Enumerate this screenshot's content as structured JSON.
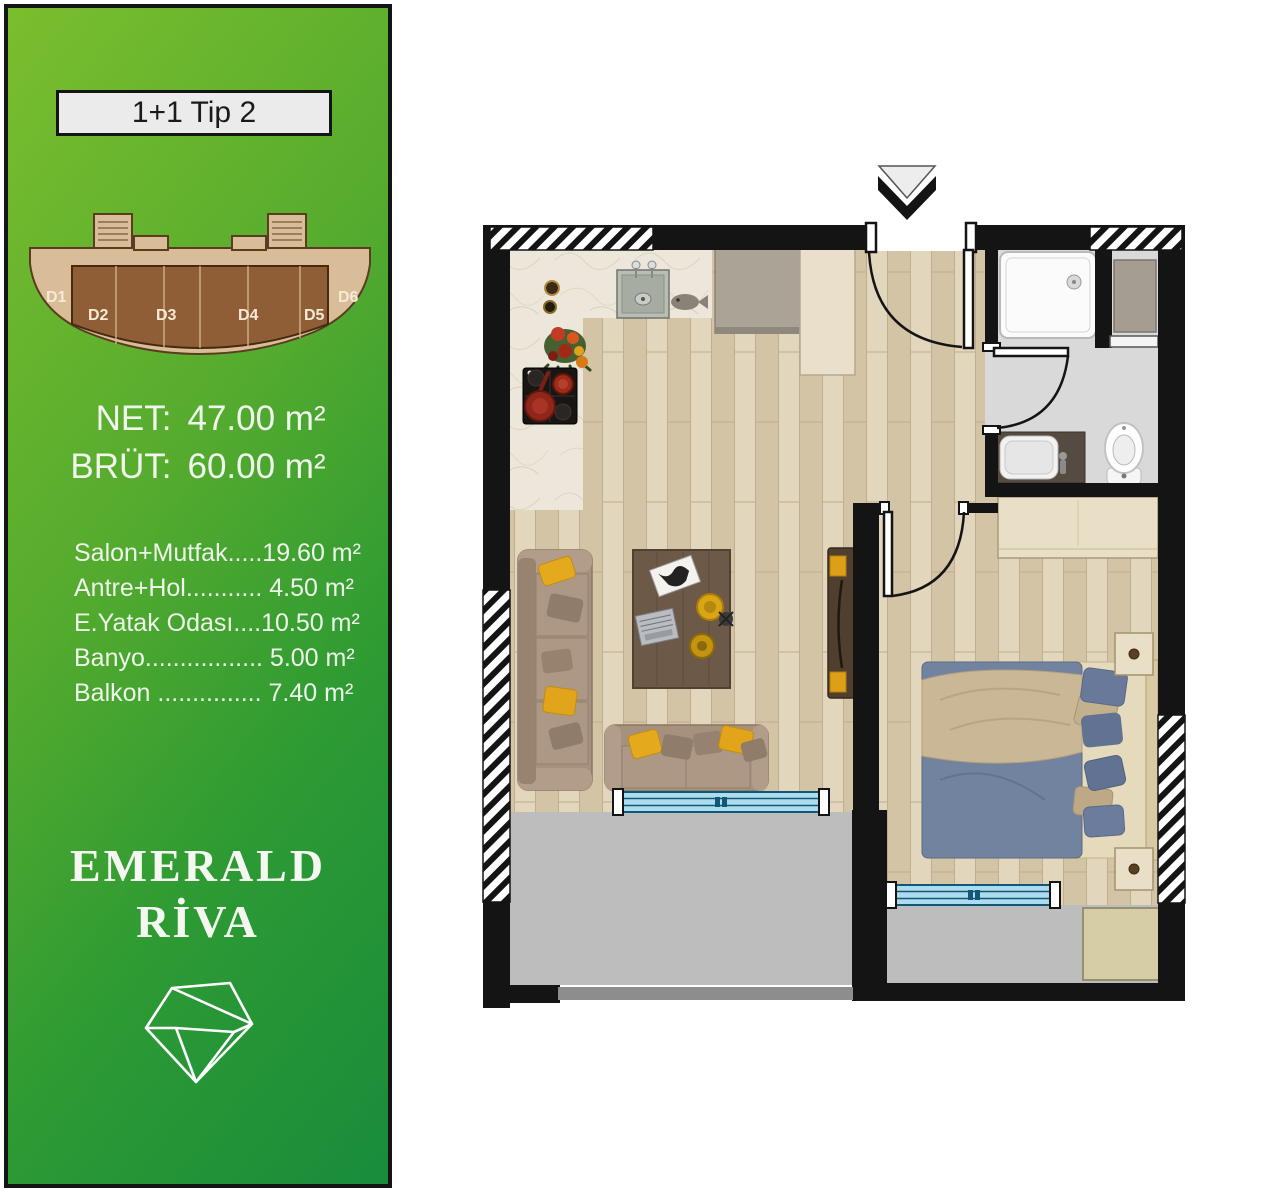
{
  "sidebar": {
    "title": "1+1 Tip 2",
    "area_summary": {
      "net_label": "NET:",
      "net_value": "47.00 m²",
      "brut_label": "BRÜT:",
      "brut_value": "60.00 m²"
    },
    "room_list": [
      "Salon+Mutfak.....19.60 m²",
      "Antre+Hol........... 4.50 m²",
      "E.Yatak Odası....10.50 m²",
      "Banyo................. 5.00 m²",
      "Balkon ............... 7.40 m²"
    ],
    "brand": {
      "line1": "EMERALD",
      "line2": "RİVA",
      "logo_icon": "diamond-outline-icon"
    },
    "keyplan": {
      "units": [
        "D1",
        "D2",
        "D3",
        "D4",
        "D5",
        "D6"
      ]
    },
    "colors": {
      "green_light": "#7bbe2e",
      "green_dark": "#198c3c",
      "text": "#f0f6ec",
      "title_box_bg": "#ebebeb"
    }
  },
  "floorplan": {
    "entry_marker_icon": "entry-arrow-icon",
    "fixture_icons": [
      "kitchen-counter",
      "kitchen-sink",
      "stove",
      "fruit-bowl",
      "fridge-cabinet",
      "hall-cabinet",
      "entrance-door",
      "shower-tray",
      "washing-machine",
      "vanity-sink",
      "toilet",
      "bathroom-door",
      "wardrobe",
      "bedroom-door",
      "double-bed",
      "nightstand",
      "sofa-long",
      "sofa-short",
      "coffee-table",
      "tv-console",
      "salon-window",
      "bedroom-window",
      "balcony-mat"
    ],
    "colors": {
      "wall": "#141414",
      "wood_floor": "#dccdb2",
      "kitchen_floor": "#ece7da",
      "bathroom_floor": "#d9d9d9",
      "balcony_floor": "#bdbdbd",
      "window_glass": "#aedcee",
      "pillow_accent": "#e5a91e",
      "bed_blue": "#72839f"
    }
  }
}
